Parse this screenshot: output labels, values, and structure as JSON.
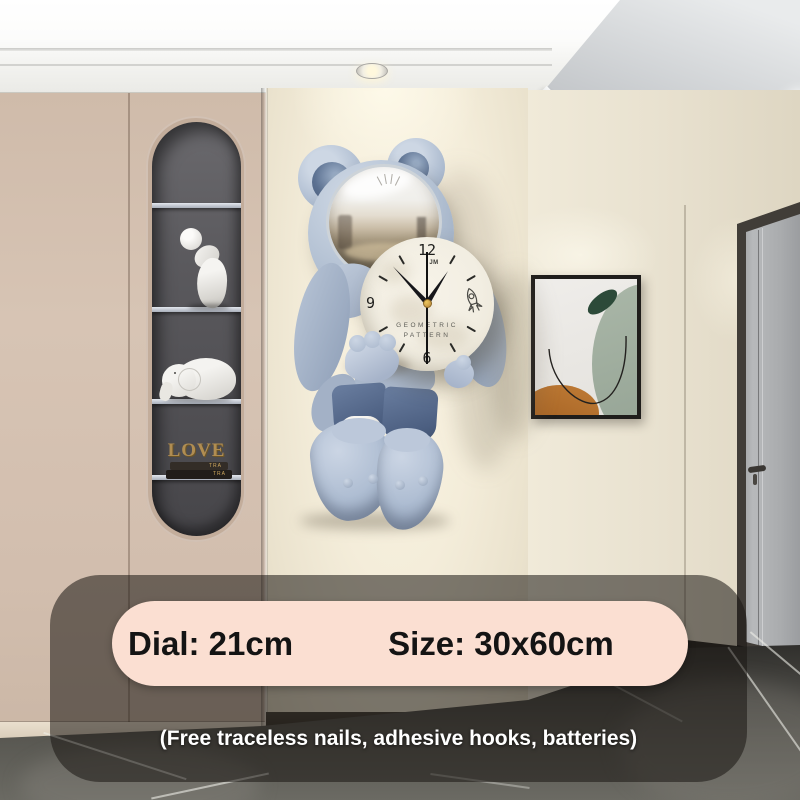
{
  "clock": {
    "brand": "JM",
    "numerals": {
      "top": "12",
      "left": "9",
      "bottom": "6"
    },
    "dial_text": {
      "line1": "GEOMETRIC",
      "line2": "PATTERN"
    },
    "icons": {
      "dial_doodle": "rocket-icon"
    },
    "colors": {
      "dial": "#f2eee3",
      "bear_body": "#aebcd2",
      "shorts": "#54688a",
      "hands": "#16161a",
      "center_cap": "#d2a344"
    }
  },
  "shelf_display": {
    "love_text": "LOVE",
    "book_spines": [
      "TRA",
      "TRA"
    ]
  },
  "info_overlay": {
    "banner": {
      "dial_label": "Dial: 21cm",
      "size_label": "Size: 30x60cm",
      "background": "#fbdfd2",
      "text_color": "#141414"
    },
    "caption": "(Free traceless nails, adhesive hooks, batteries)",
    "caption_color": "#ffffff",
    "panel_background": "rgba(25,22,18,0.55)"
  },
  "room_palette": {
    "ceiling": "#f7f7f5",
    "cabinet": "#d3bfae",
    "niche": "#555458",
    "center_wall": "#f3ecd9",
    "right_wall": "#e8e1d0",
    "floor": "#4a4945",
    "door": "#b0b2b4",
    "art_sage": "#9fae9f",
    "art_green": "#2c4a39",
    "art_orange": "#b06a28"
  }
}
